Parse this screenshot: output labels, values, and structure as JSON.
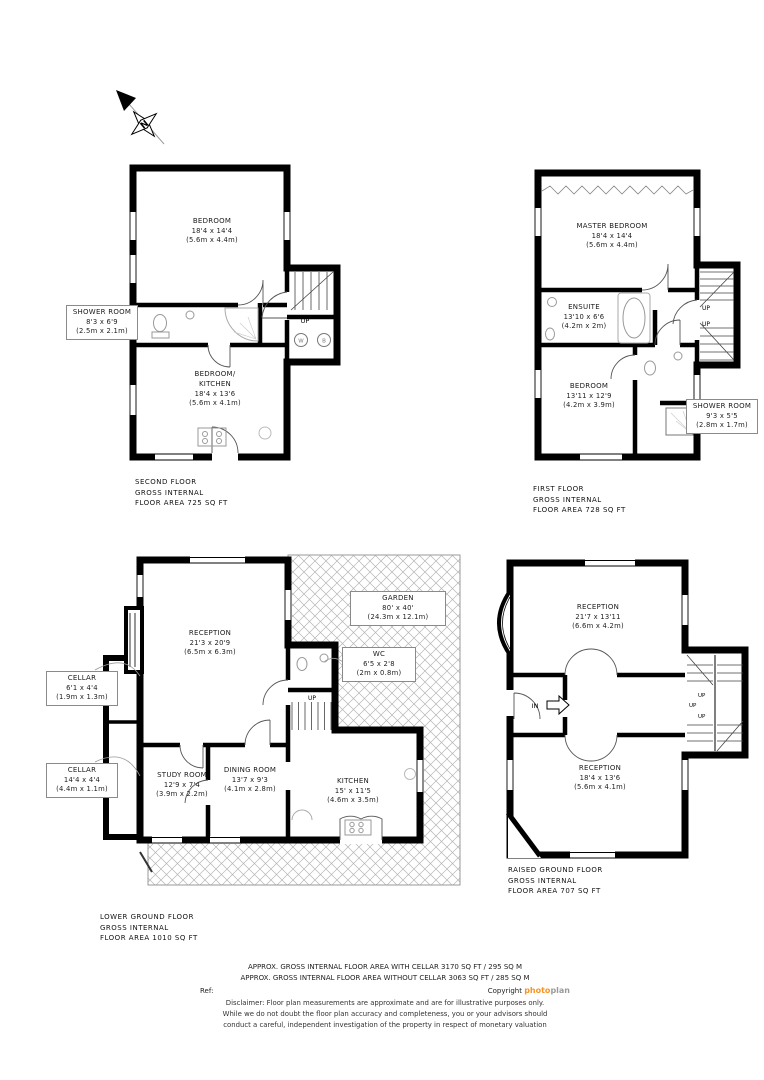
{
  "labels": {
    "up": "UP",
    "in": "IN",
    "washer": "W",
    "boiler": "B",
    "north": "N"
  },
  "colors": {
    "wall_black": "#000000",
    "fixture_gray": "#999999",
    "hatch_gray": "#b5b5b5",
    "brand_orange": "#F7941E",
    "brand_gray": "#9a9a9a"
  },
  "floors": {
    "second_floor": {
      "title": [
        "SECOND FLOOR",
        "GROSS INTERNAL",
        "FLOOR AREA 725 SQ FT"
      ],
      "rooms": {
        "bedroom": {
          "name": "BEDROOM",
          "imperial": "18'4 x 14'4",
          "metric": "(5.6m x 4.4m)"
        },
        "shower_room": {
          "name": "SHOWER ROOM",
          "imperial": "8'3 x 6'9",
          "metric": "(2.5m x 2.1m)"
        },
        "bedroom_kitchen": {
          "name1": "BEDROOM/",
          "name2": "KITCHEN",
          "imperial": "18'4 x 13'6",
          "metric": "(5.6m x 4.1m)"
        }
      }
    },
    "first_floor": {
      "title": [
        "FIRST FLOOR",
        "GROSS INTERNAL",
        "FLOOR AREA 728 SQ FT"
      ],
      "rooms": {
        "master_bedroom": {
          "name": "MASTER BEDROOM",
          "imperial": "18'4 x 14'4",
          "metric": "(5.6m x 4.4m)"
        },
        "ensuite": {
          "name": "ENSUITE",
          "imperial": "13'10 x 6'6",
          "metric": "(4.2m x 2m)"
        },
        "bedroom": {
          "name": "BEDROOM",
          "imperial": "13'11 x 12'9",
          "metric": "(4.2m x 3.9m)"
        },
        "shower_room": {
          "name": "SHOWER ROOM",
          "imperial": "9'3 x 5'5",
          "metric": "(2.8m x 1.7m)"
        }
      }
    },
    "lower_ground": {
      "title": [
        "LOWER GROUND FLOOR",
        "GROSS INTERNAL",
        "FLOOR AREA 1010 SQ FT"
      ],
      "rooms": {
        "garden": {
          "name": "GARDEN",
          "imperial": "80' x 40'",
          "metric": "(24.3m x 12.1m)"
        },
        "reception": {
          "name": "RECEPTION",
          "imperial": "21'3 x 20'9",
          "metric": "(6.5m x 6.3m)"
        },
        "wc": {
          "name": "WC",
          "imperial": "6'5 x 2'8",
          "metric": "(2m x 0.8m)"
        },
        "cellar_small": {
          "name": "CELLAR",
          "imperial": "6'1 x 4'4",
          "metric": "(1.9m x 1.3m)"
        },
        "cellar_long": {
          "name": "CELLAR",
          "imperial": "14'4 x 4'4",
          "metric": "(4.4m x 1.1m)"
        },
        "study": {
          "name": "STUDY ROOM",
          "imperial": "12'9 x 7'4",
          "metric": "(3.9m x 2.2m)"
        },
        "dining": {
          "name": "DINING ROOM",
          "imperial": "13'7 x 9'3",
          "metric": "(4.1m x 2.8m)"
        },
        "kitchen": {
          "name": "KITCHEN",
          "imperial": "15' x 11'5",
          "metric": "(4.6m x 3.5m)"
        }
      }
    },
    "raised_ground": {
      "title": [
        "RAISED GROUND FLOOR",
        "GROSS INTERNAL",
        "FLOOR AREA 707 SQ FT"
      ],
      "rooms": {
        "reception_front": {
          "name": "RECEPTION",
          "imperial": "21'7 x 13'11",
          "metric": "(6.6m x 4.2m)"
        },
        "reception_back": {
          "name": "RECEPTION",
          "imperial": "18'4 x 13'6",
          "metric": "(5.6m x 4.1m)"
        }
      }
    }
  },
  "footer": {
    "approx_with_cellar": "APPROX. GROSS INTERNAL FLOOR AREA WITH CELLAR 3170 SQ FT / 295 SQ M",
    "approx_without_cellar": "APPROX. GROSS INTERNAL FLOOR AREA WITHOUT CELLAR 3063 SQ FT / 285 SQ M",
    "ref_label": "Ref:",
    "copyright_label": "Copyright",
    "brand_photo": "photo",
    "brand_plan": "plan",
    "disclaimer_1": "Disclaimer: Floor plan measurements are approximate and are for illustrative purposes only.",
    "disclaimer_2": "While we do not doubt the floor plan accuracy and completeness, you or your advisors should",
    "disclaimer_3": "conduct a careful, independent investigation of the property in respect of monetary valuation"
  }
}
